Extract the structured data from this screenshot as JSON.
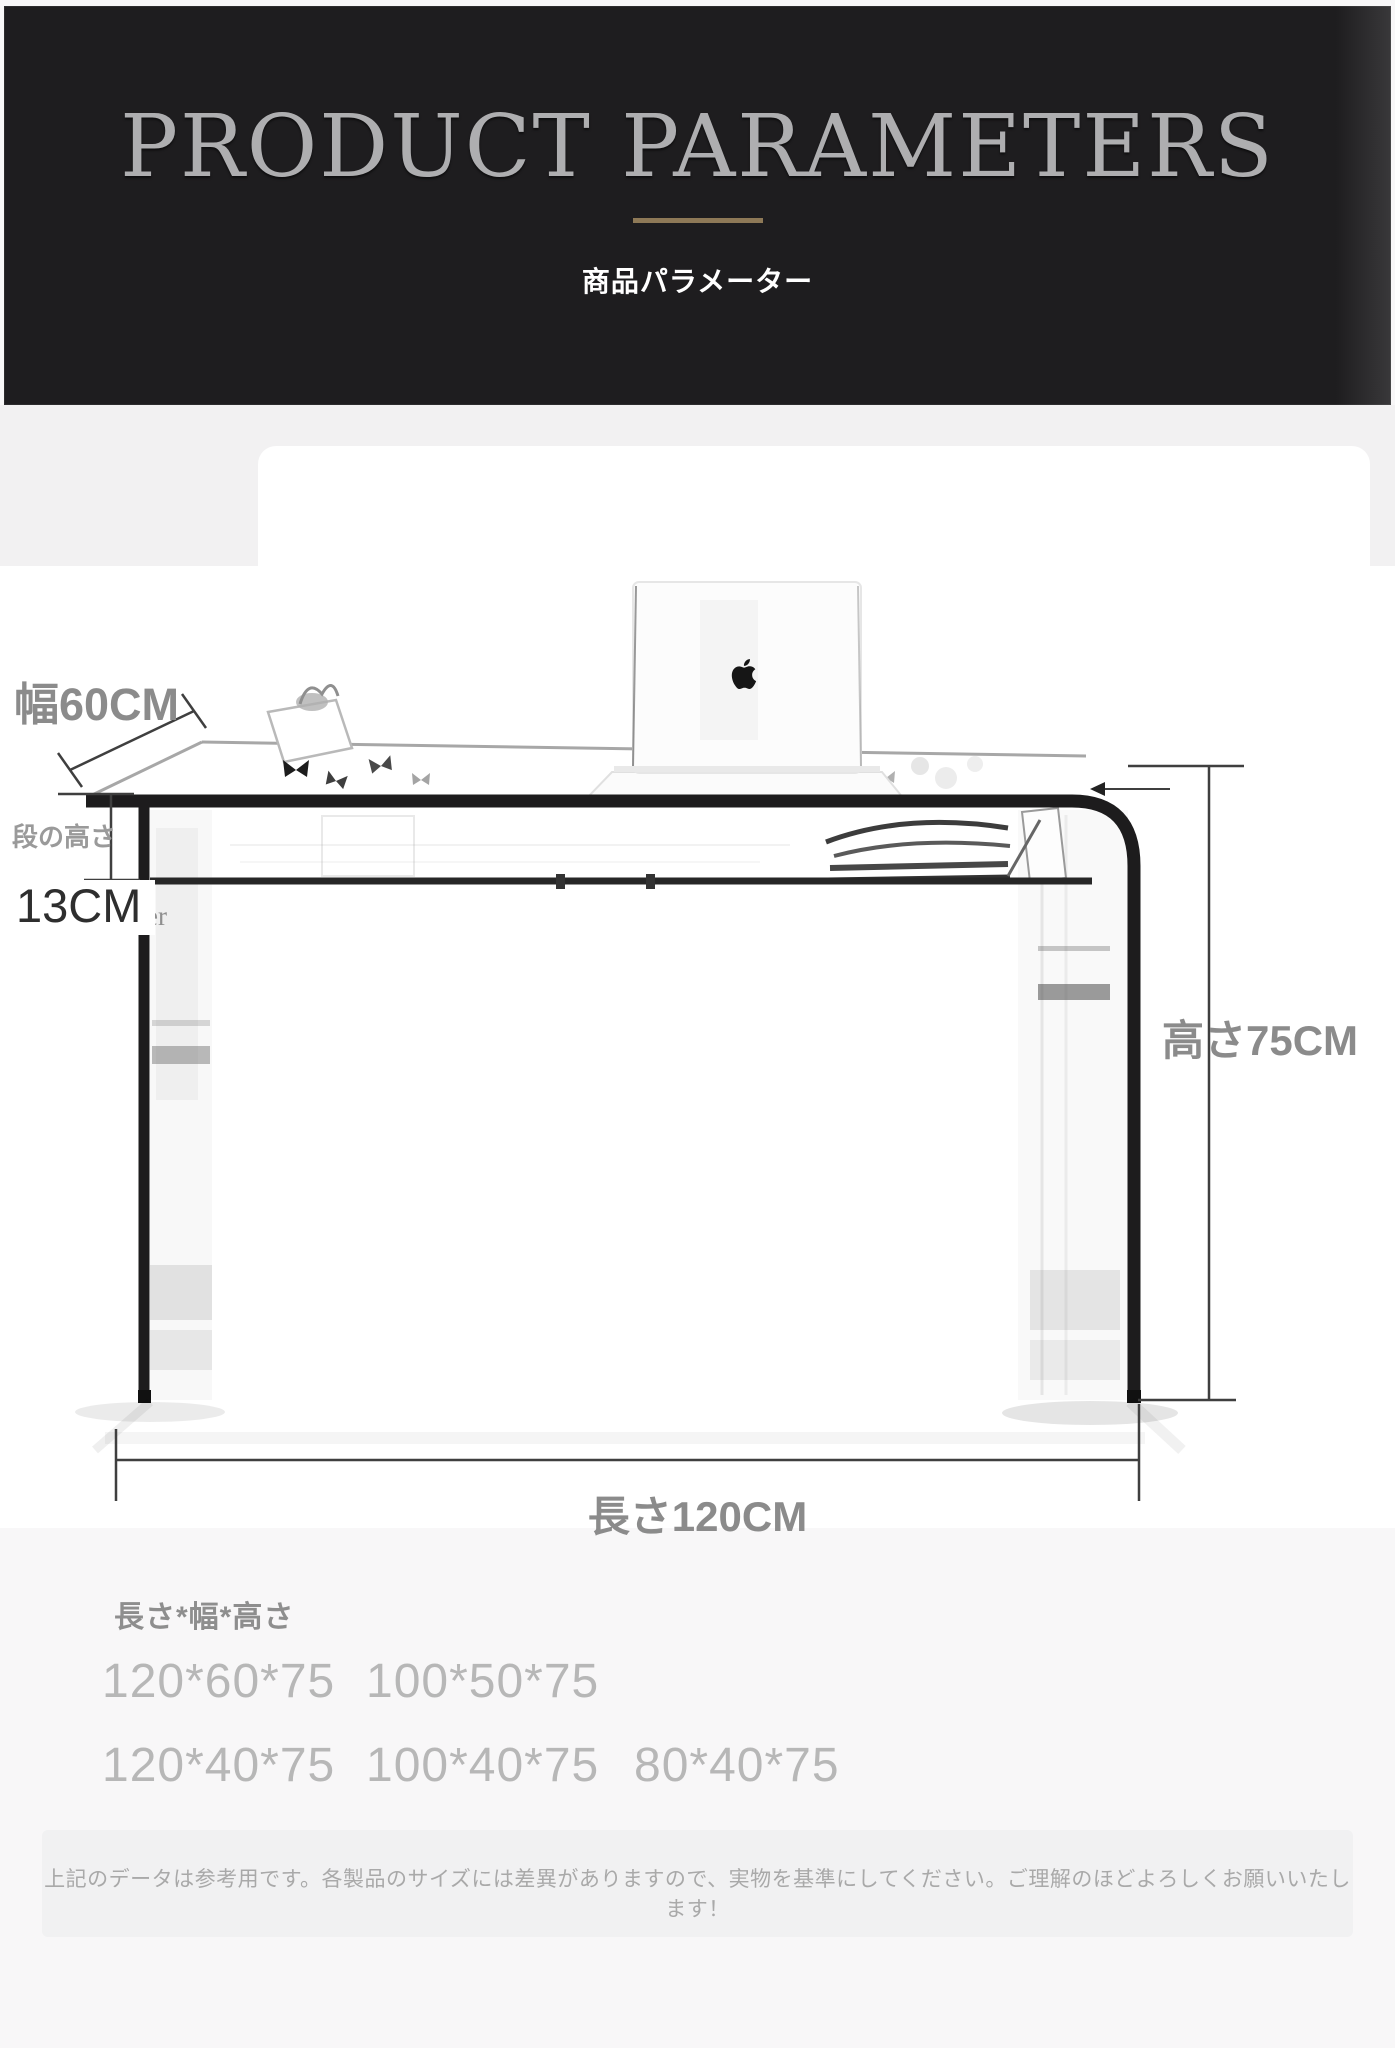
{
  "header": {
    "title": "PRODUCT PARAMETERS",
    "subtitle": "商品パラメーター"
  },
  "colors": {
    "header_bg": "#1e1d1f",
    "title_silver": "#aeaeb0",
    "divider_gold": "#8e7957",
    "label_gray": "#8b8b8b",
    "size_value_gray": "#b7b7b7",
    "desk_outline": "#1d1c1d"
  },
  "diagram": {
    "width_label": "幅60CM",
    "step_height_caption": "段の高さ",
    "step_height_value": "13CM",
    "height_label": "高さ75CM",
    "length_label": "長さ120CM",
    "laptop_icon": "apple-logo",
    "leg_reflection_text": "er"
  },
  "sizes": {
    "heading": "長さ*幅*高さ",
    "rows": [
      [
        "120*60*75",
        "100*50*75"
      ],
      [
        "120*40*75",
        "100*40*75",
        "80*40*75"
      ]
    ]
  },
  "footer": {
    "note": "上記のデータは参考用です。各製品のサイズには差異がありますので、実物を基準にしてください。ご理解のほどよろしくお願いいたします！"
  }
}
